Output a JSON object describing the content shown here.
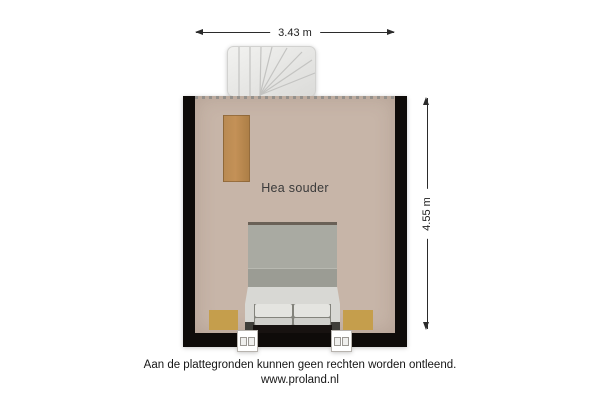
{
  "page": {
    "background": "#ffffff"
  },
  "dimensions": {
    "width_label": "3.43 m",
    "height_label": "4.55 m"
  },
  "room": {
    "label": "Hea souder",
    "floor_color": "#c7b5a8",
    "wall_color": "#0e0b09"
  },
  "furniture": [
    {
      "name": "staircase",
      "color": "#ebebe9"
    },
    {
      "name": "sideboard",
      "color": "#b98a52"
    },
    {
      "name": "bed",
      "duvet_color": "#a9aaa2",
      "frame_color": "#d8d8d4",
      "headboard_color": "#171210"
    },
    {
      "name": "nightstand-left",
      "color": "#c59e4c"
    },
    {
      "name": "nightstand-right",
      "color": "#c59e4c"
    },
    {
      "name": "window-left",
      "color": "#ffffff"
    },
    {
      "name": "window-right",
      "color": "#ffffff"
    }
  ],
  "footer": {
    "disclaimer": "Aan de plattegronden kunnen geen rechten worden ontleend.",
    "website": "www.proland.nl"
  }
}
